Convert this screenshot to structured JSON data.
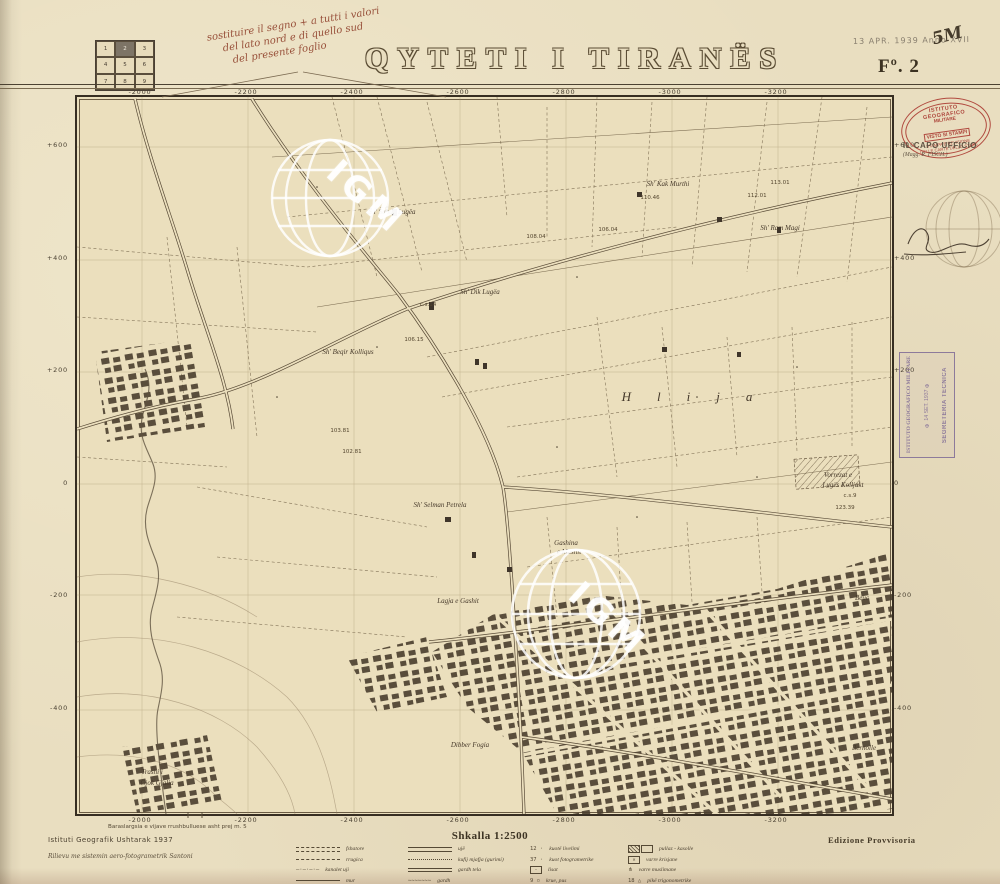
{
  "sheet": {
    "title": "QYTETI I TIRANËS",
    "sheet_no": "Fº. 2",
    "date_stamp": "13 APR. 1939 Anno XVII",
    "hand_mark": "5M",
    "note_lines": [
      "sostituire il segno + a tutti i valori",
      "del lato nord e di quello sud",
      "del presente foglio"
    ],
    "index_grid": {
      "cells": [
        "1",
        "2",
        "3",
        "4",
        "5",
        "6",
        "7",
        "8",
        "9"
      ],
      "active": "2"
    }
  },
  "stamps": {
    "oval": {
      "l1": "ISTITUTO GEOGRAFICO",
      "l2": "MILITARE",
      "box": "VISTO SI STAMPI",
      "l3": "STAMPA E REVISIONE",
      "l4": "DELLE CARTE DELLO STATO"
    },
    "capo": {
      "l1": "IL CAPO UFFICIO",
      "l2": "(Magg. R. FISCH.)"
    },
    "purple": {
      "l1": "ISTITUTO GEOGRAFICO MILITARE",
      "l2": "✠ 14 SET. 1937 ✠",
      "l3": "SEGRETERIA TECNICA"
    }
  },
  "map": {
    "watermark": "IGM",
    "grid": {
      "x_labels": [
        "-2000",
        "-2200",
        "-2400",
        "-2600",
        "-2800",
        "-3000",
        "-3200"
      ],
      "y_labels": [
        "+600",
        "+400",
        "+200",
        "0",
        "-200",
        "-400"
      ]
    },
    "labels": [
      {
        "t": "Sh' Saban Lugëa",
        "x": 392,
        "y": 212,
        "c": "name"
      },
      {
        "t": "Sh' Kak Murthi",
        "x": 668,
        "y": 184,
        "c": "name"
      },
      {
        "t": "112.01",
        "x": 757,
        "y": 196,
        "c": "num"
      },
      {
        "t": "113.01",
        "x": 780,
        "y": 183,
        "c": "num"
      },
      {
        "t": "110.46",
        "x": 650,
        "y": 198,
        "c": "num"
      },
      {
        "t": "Sh' Ram Magi",
        "x": 780,
        "y": 228,
        "c": "name"
      },
      {
        "t": "106.04",
        "x": 608,
        "y": 230,
        "c": "num"
      },
      {
        "t": "108.04",
        "x": 536,
        "y": 237,
        "c": "num"
      },
      {
        "t": "Sh' Dik Lugëa",
        "x": 480,
        "y": 292,
        "c": "name"
      },
      {
        "t": "c.s.14",
        "x": 428,
        "y": 305,
        "c": "num"
      },
      {
        "t": "106.15",
        "x": 414,
        "y": 340,
        "c": "num"
      },
      {
        "t": "Sh' Beqir Kolliqus",
        "x": 348,
        "y": 352,
        "c": "name"
      },
      {
        "t": "Hlija",
        "x": 700,
        "y": 397,
        "c": "district"
      },
      {
        "t": "103.81",
        "x": 340,
        "y": 431,
        "c": "num"
      },
      {
        "t": "102.81",
        "x": 352,
        "y": 452,
        "c": "num"
      },
      {
        "t": "Vorrezat e",
        "x": 838,
        "y": 475,
        "c": "name"
      },
      {
        "t": "Lugës Kolljakt",
        "x": 843,
        "y": 485,
        "c": "name"
      },
      {
        "t": "c.s.9",
        "x": 850,
        "y": 496,
        "c": "num"
      },
      {
        "t": "123.39",
        "x": 845,
        "y": 508,
        "c": "num"
      },
      {
        "t": "Sh' Selman Petrela",
        "x": 440,
        "y": 505,
        "c": "name"
      },
      {
        "t": "Gashina",
        "x": 566,
        "y": 543,
        "c": "name"
      },
      {
        "t": "e Mashit",
        "x": 569,
        "y": 552,
        "c": "name"
      },
      {
        "t": "Lagja e Gashit",
        "x": 458,
        "y": 601,
        "c": "name"
      },
      {
        "t": "Beuc",
        "x": 862,
        "y": 598,
        "c": "name"
      },
      {
        "t": "Dibber Fogia",
        "x": 470,
        "y": 745,
        "c": "name"
      },
      {
        "t": "Bernolle",
        "x": 864,
        "y": 748,
        "c": "name"
      },
      {
        "t": "Trashi i",
        "x": 152,
        "y": 772,
        "c": "name"
      },
      {
        "t": "Gjok Gjalia",
        "x": 157,
        "y": 783,
        "c": "name"
      }
    ]
  },
  "footer": {
    "contour_note": "Baraslargsia e vijave rrushbulluese asht prej m. 5",
    "agency": "Istituti Geografik Ushtarak 1937",
    "survey": "Rilievu me sistemin aero-fotogrametrik Santoni",
    "scale_label": "Shkalla 1:2500",
    "edition": "Edizione Provvisoria",
    "legend": {
      "cols": [
        {
          "x": 296,
          "items": [
            {
              "sym": "ddash",
              "label": "fshatore"
            },
            {
              "sym": "dash",
              "label": "rrugica"
            },
            {
              "sym": "dashdot",
              "label": "kanalet uji"
            },
            {
              "sym": "solid",
              "label": "mur"
            }
          ]
        },
        {
          "x": 408,
          "items": [
            {
              "sym": "dsolid",
              "label": "ujë"
            },
            {
              "sym": "dots",
              "label": "kufij mjafja (gurimi)"
            },
            {
              "sym": "dsolid2",
              "label": "gardh tela"
            },
            {
              "sym": "wavy",
              "label": "gardh"
            }
          ]
        },
        {
          "x": 530,
          "items": [
            {
              "sym": "t12",
              "label": "kuotë livelimi"
            },
            {
              "sym": "t37",
              "label": "kuot fotogrametrike"
            },
            {
              "sym": "rect",
              "label": "lisat"
            },
            {
              "sym": "well",
              "label": "krue, pus"
            }
          ]
        },
        {
          "x": 628,
          "items": [
            {
              "sym": "roof",
              "label": "pullaz - kasolle"
            },
            {
              "sym": "gravex",
              "label": "varre krisjane"
            },
            {
              "sym": "gravem",
              "label": "varre muslimane"
            },
            {
              "sym": "trig",
              "label": "pikë trigonometrike"
            }
          ]
        }
      ]
    }
  }
}
